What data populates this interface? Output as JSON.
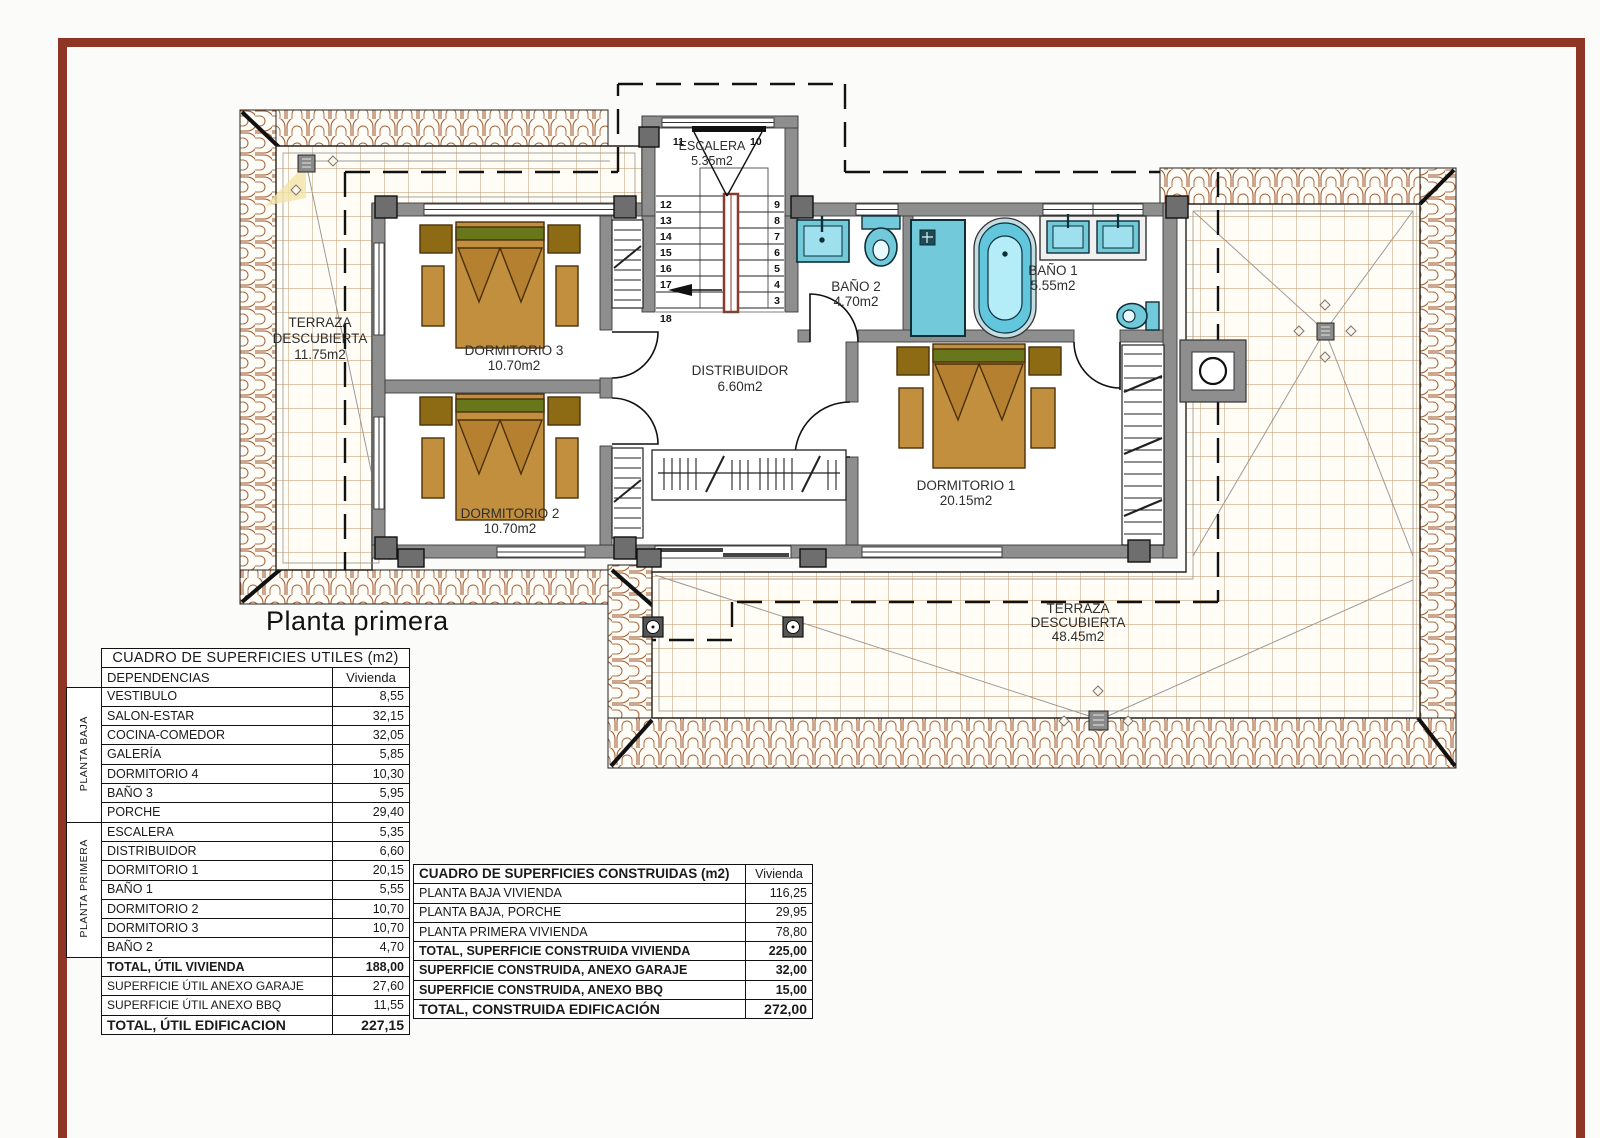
{
  "title": "Planta primera",
  "frame_color": "#8e3525",
  "plan": {
    "labels": {
      "terraza_left": {
        "l1": "TERRAZA",
        "l2": "DESCUBIERTA",
        "l3": "11.75m2"
      },
      "escalera": {
        "l1": "ESCALERA",
        "l2": "5.35m2"
      },
      "bano2": {
        "l1": "BAÑO 2",
        "l2": "4.70m2"
      },
      "bano1": {
        "l1": "BAÑO 1",
        "l2": "5.55m2"
      },
      "distribuidor": {
        "l1": "DISTRIBUIDOR",
        "l2": "6.60m2"
      },
      "dormitorio3": {
        "l1": "DORMITORIO 3",
        "l2": "10.70m2"
      },
      "dormitorio2": {
        "l1": "DORMITORIO 2",
        "l2": "10.70m2"
      },
      "dormitorio1": {
        "l1": "DORMITORIO 1",
        "l2": "20.15m2"
      },
      "terraza_bottom": {
        "l1": "TERRAZA",
        "l2": "DESCUBIERTA",
        "l3": "48.45m2"
      }
    },
    "stair_numbers": {
      "top_left": "11",
      "top_right": "10",
      "right": [
        "9",
        "8",
        "7",
        "6",
        "5",
        "4",
        "3"
      ],
      "left": [
        "12",
        "13",
        "14",
        "15",
        "16",
        "17",
        "18"
      ]
    }
  },
  "tables": {
    "utiles": {
      "title": "CUADRO DE SUPERFICIES UTILES (m2)",
      "col_name": "DEPENDENCIAS",
      "col_value": "Vivienda",
      "groups": [
        {
          "label": "PLANTA BAJA",
          "rows": [
            [
              "VESTIBULO",
              "8,55"
            ],
            [
              "SALON-ESTAR",
              "32,15"
            ],
            [
              "COCINA-COMEDOR",
              "32,05"
            ],
            [
              "GALERÍA",
              "5,85"
            ],
            [
              "DORMITORIO 4",
              "10,30"
            ],
            [
              "BAÑO 3",
              "5,95"
            ],
            [
              "PORCHE",
              "29,40"
            ]
          ]
        },
        {
          "label": "PLANTA PRIMERA",
          "rows": [
            [
              "ESCALERA",
              "5,35"
            ],
            [
              "DISTRIBUIDOR",
              "6,60"
            ],
            [
              "DORMITORIO 1",
              "20,15"
            ],
            [
              "BAÑO 1",
              "5,55"
            ],
            [
              "DORMITORIO 2",
              "10,70"
            ],
            [
              "DORMITORIO 3",
              "10,70"
            ],
            [
              "BAÑO 2",
              "4,70"
            ]
          ]
        }
      ],
      "totals": [
        {
          "name": "TOTAL, ÚTIL VIVIENDA",
          "value": "188,00"
        },
        {
          "name": "SUPERFICIE ÚTIL ANEXO GARAJE",
          "value": "27,60"
        },
        {
          "name": "SUPERFICIE ÚTIL ANEXO BBQ",
          "value": "11,55"
        },
        {
          "name": "TOTAL, ÚTIL EDIFICACION",
          "value": "227,15"
        }
      ]
    },
    "construidas": {
      "title": "CUADRO DE SUPERFICIES CONSTRUIDAS (m2)",
      "col_value": "Vivienda",
      "rows": [
        {
          "name": "PLANTA BAJA VIVIENDA",
          "value": "116,25"
        },
        {
          "name": "PLANTA BAJA, PORCHE",
          "value": "29,95"
        },
        {
          "name": "PLANTA PRIMERA VIVIENDA",
          "value": "78,80"
        },
        {
          "name": "TOTAL, SUPERFICIE CONSTRUIDA VIVIENDA",
          "value": "225,00"
        },
        {
          "name": "SUPERFICIE CONSTRUIDA, ANEXO GARAJE",
          "value": "32,00"
        },
        {
          "name": "SUPERFICIE CONSTRUIDA, ANEXO BBQ",
          "value": "15,00"
        },
        {
          "name": "TOTAL, CONSTRUIDA EDIFICACIÓN",
          "value": "272,00"
        }
      ]
    }
  }
}
